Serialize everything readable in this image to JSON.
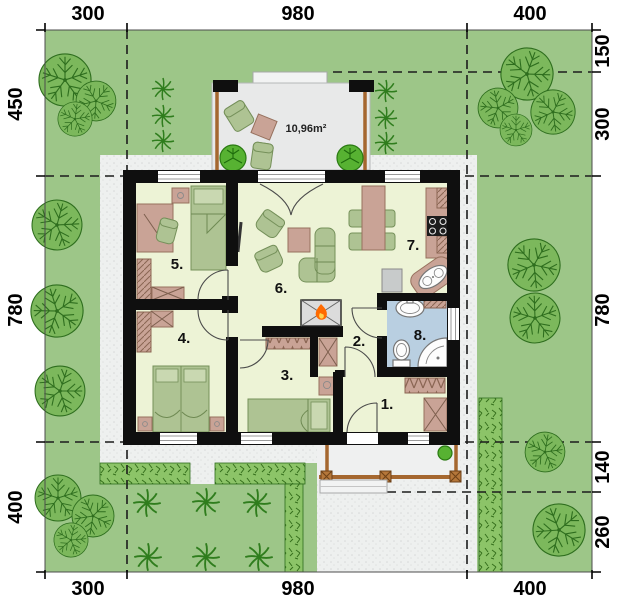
{
  "dimensions": {
    "top": [
      "300",
      "980",
      "400"
    ],
    "bottom": [
      "300",
      "980",
      "400"
    ],
    "left": [
      "450",
      "780",
      "400"
    ],
    "right": [
      "150",
      "300",
      "780",
      "140",
      "260"
    ]
  },
  "rooms": {
    "labels": [
      "1.",
      "2.",
      "3.",
      "4.",
      "5.",
      "6.",
      "7.",
      "8."
    ]
  },
  "terrace": {
    "area_label": "10,96m²"
  },
  "colors": {
    "grass": "#9dc688",
    "tree": "#7cb85c",
    "tree_outline": "#2e6e1e",
    "bush": "#57b232",
    "hedge": "#8cc468",
    "pavement": "#eef0ef",
    "terrace_floor": "#e8e9e9",
    "wall": "#0f0f0f",
    "room_floor": "#edf3d6",
    "bathroom_floor": "#b9cfe1",
    "furniture_green": "#aec393",
    "furniture_wood": "#c9a396",
    "wood_beam": "#a5672f",
    "flame": "#ff6a00",
    "dimension_text": "#000000"
  }
}
